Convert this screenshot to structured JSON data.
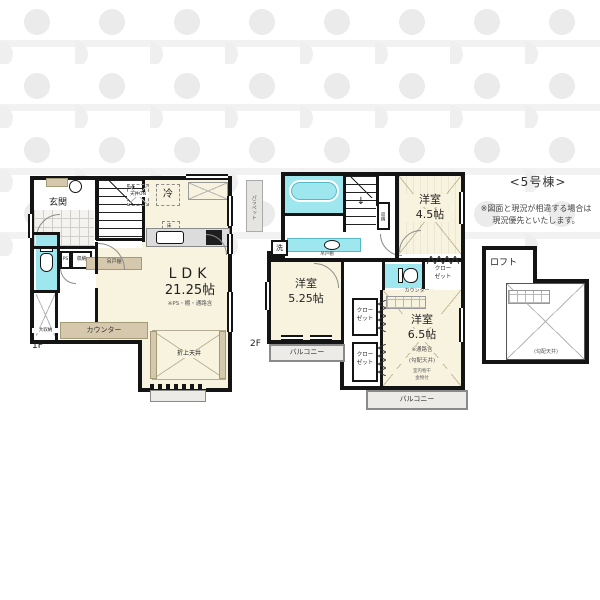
{
  "colors": {
    "wall": "#141414",
    "room_cream": "#f8f3df",
    "wet_cyan": "#9fe7ee",
    "furniture_tan": "#d5c8ad",
    "balcony_gray": "#ecebe7"
  },
  "building": {
    "title": "<5号棟>",
    "note_line1": "※図面と現況が相違する場合は",
    "note_line2": "現況優先といたします。"
  },
  "floor1": {
    "label": "1F",
    "genkan": "玄関",
    "ceiling_box": "天井ON",
    "fridge": "冷",
    "underfloor_storage": "床下収納",
    "ps": "PS",
    "storage": "収納",
    "hanging_cupboard": "吊戸棚",
    "large_storage": "大収納",
    "counter": "カウンター",
    "coffered_ceiling": "折上天井",
    "ldk_name": "LDK",
    "ldk_size": "21.25帖",
    "ldk_note": "※PS・棚・通路含"
  },
  "floor2": {
    "label": "2F",
    "parapet": "パラペット",
    "washer": "洗",
    "hanging_cupboard": "吊戸棚",
    "stair_storage": "収納",
    "room45_name": "洋室",
    "room45_size": "4.5帖",
    "room525_name": "洋室",
    "room525_size": "5.25帖",
    "room65_name": "洋室",
    "room65_size": "6.5帖",
    "room65_note": "※通路含",
    "room65_ceiling": "(勾配天井)",
    "laundry_line1": "室内物干",
    "laundry_line2": "金物付",
    "counter": "カウンター",
    "closet_line1": "クロー",
    "closet_line2": "ゼット",
    "balcony": "バルコニー"
  },
  "loft": {
    "label": "ロフト",
    "ceiling": "(勾配天井)"
  },
  "icons": {
    "stair_arrow_1f": "→",
    "stair_arrow_2f": "↓"
  }
}
